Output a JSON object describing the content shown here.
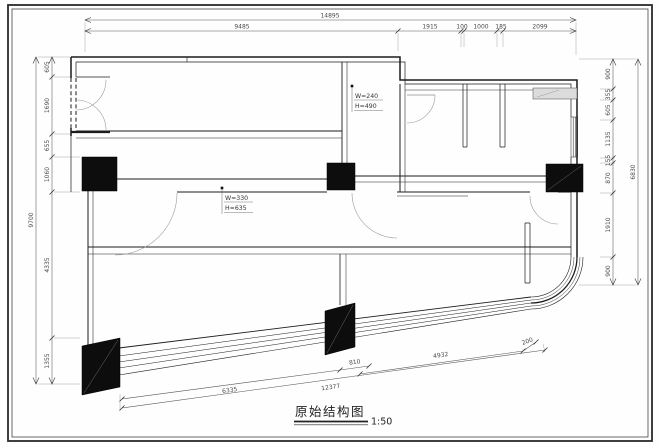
{
  "title": {
    "text": "原始结构图",
    "scale": "1:50"
  },
  "dims": {
    "top": {
      "overall": "14895",
      "segments": [
        "9485",
        "1915",
        "100",
        "1000",
        "185",
        "2099"
      ]
    },
    "left": {
      "overall": "9700",
      "segments": [
        "605",
        "1690",
        "655",
        "1060",
        "4335",
        "1355"
      ]
    },
    "right": {
      "overall": "6830",
      "segments": [
        "900",
        "355",
        "605",
        "1135",
        "155",
        "870",
        "1910",
        "900"
      ]
    },
    "bottom": {
      "segments": [
        "6335",
        "810",
        "12377",
        "4932",
        "200"
      ]
    }
  },
  "annotations": {
    "beam_mid": {
      "w": "W=330",
      "h": "H=635"
    },
    "beam_top": {
      "w": "W=240",
      "h": "H=490"
    }
  },
  "colors": {
    "ink": "#1c1c1c",
    "column_fill": "#0d0d0d",
    "sill_fill": "#dcdcdc"
  }
}
